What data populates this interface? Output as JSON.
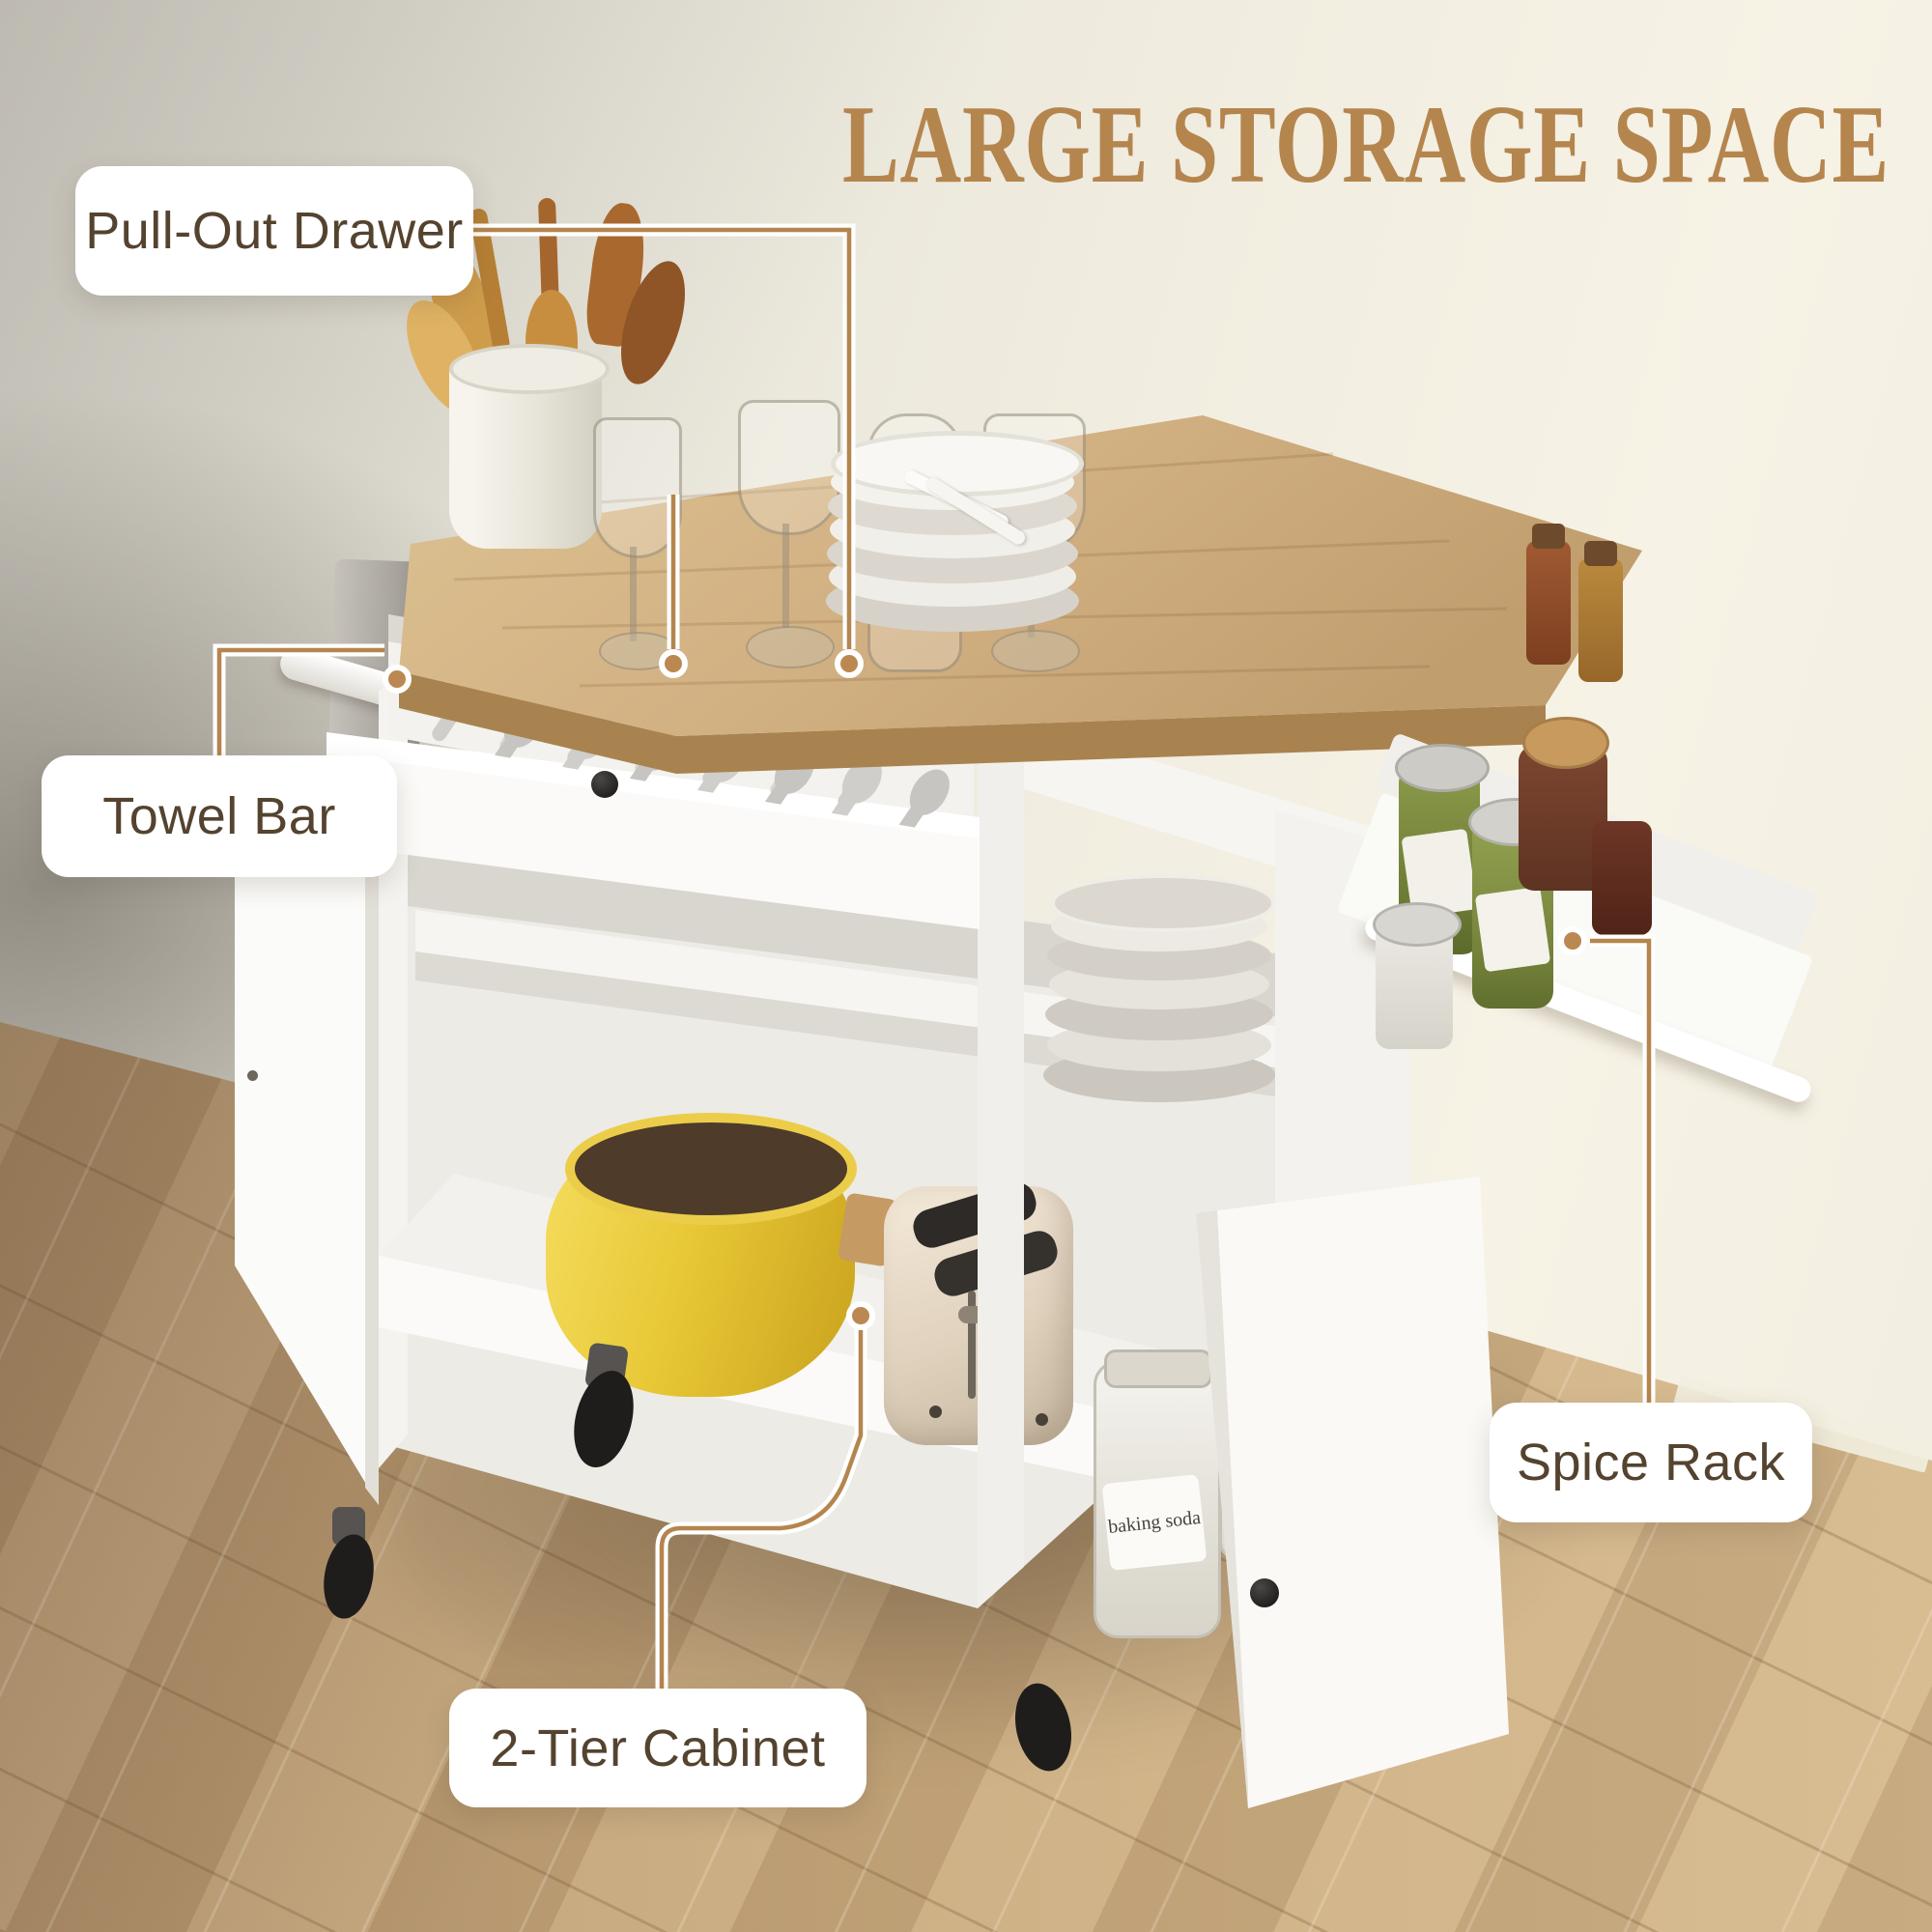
{
  "title": {
    "text": "LARGE STORAGE SPACE"
  },
  "callouts": [
    {
      "id": "pull-out-drawer",
      "label": "Pull-Out Drawer"
    },
    {
      "id": "towel-bar",
      "label": "Towel Bar"
    },
    {
      "id": "spice-rack",
      "label": "Spice Rack"
    },
    {
      "id": "two-tier-cabinet",
      "label": "2-Tier Cabinet"
    }
  ],
  "product_scene": {
    "objects": [
      "rolling kitchen island cart with oak-tone countertop",
      "open pull-out drawer filled with silverware",
      "ceramic crock with wooden utensils",
      "four drinking glasses",
      "stack of white dinner plates with forks",
      "grey towel on side towel bar",
      "side-mounted spice rack tray with jars",
      "two-tier cabinet with open doors",
      "yellow dutch oven pot",
      "cream retro toaster",
      "glass storage jars",
      "herringbone wood floor"
    ],
    "jar_label": "baking soda",
    "toaster_button_label": "STOP",
    "colors": {
      "accent_line": "#b5854e",
      "label_text": "#54432f",
      "label_background": "#ffffff",
      "countertop_wood": "#d2b183",
      "cabinet_body": "#f7f6f3",
      "floor_wood": "#c9a97c",
      "pot_yellow": "#e8c836",
      "wall": "#efece1"
    }
  }
}
